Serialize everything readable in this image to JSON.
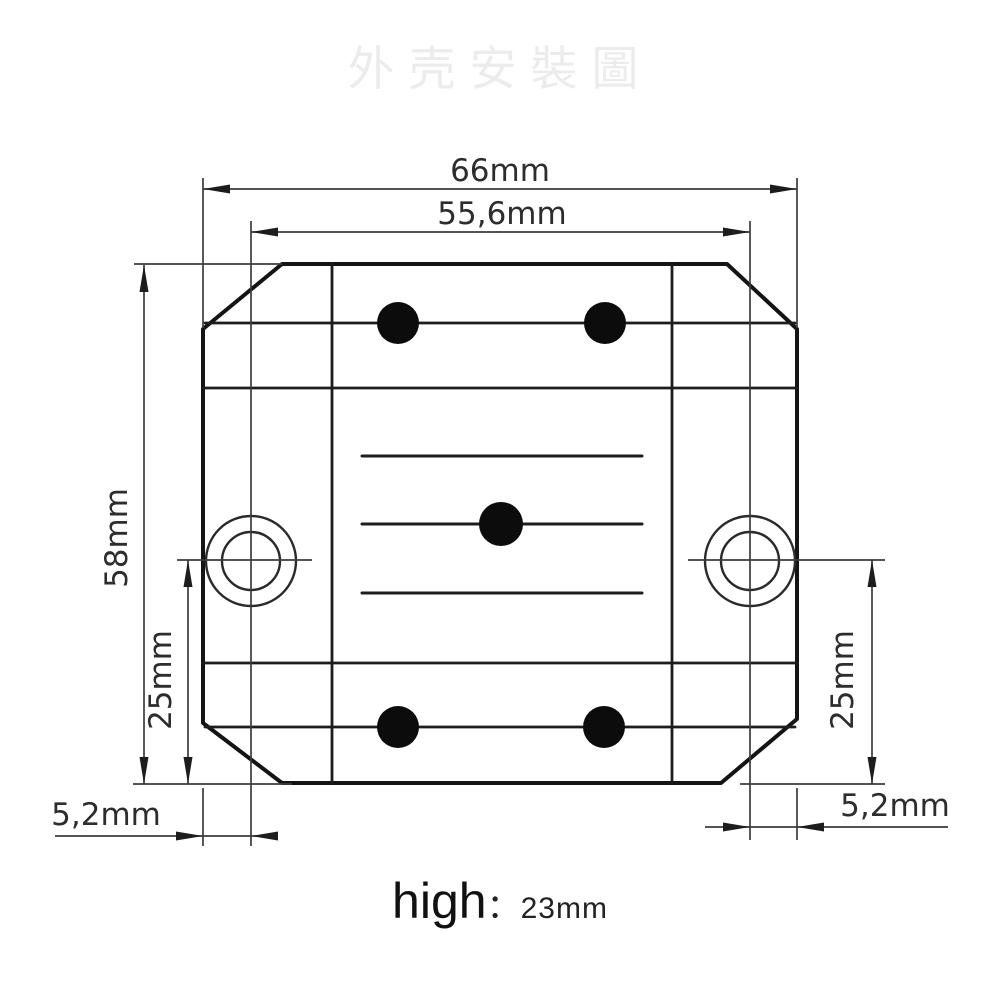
{
  "title": "外壳安裝圖",
  "colors": {
    "outline": "#141414",
    "dimension_lines": "#3c3c3c",
    "watermark": "#ececec"
  },
  "dimensions": {
    "overall_width": "66mm",
    "hole_spacing": "55,6mm",
    "overall_height": "58mm",
    "hole_to_bottom_left": "25mm",
    "hole_to_bottom_right": "25mm",
    "edge_to_hole_left": "5,2mm",
    "edge_to_hole_right": "5,2mm"
  },
  "footer": {
    "label": "high",
    "separator": "：",
    "value": "23mm"
  }
}
